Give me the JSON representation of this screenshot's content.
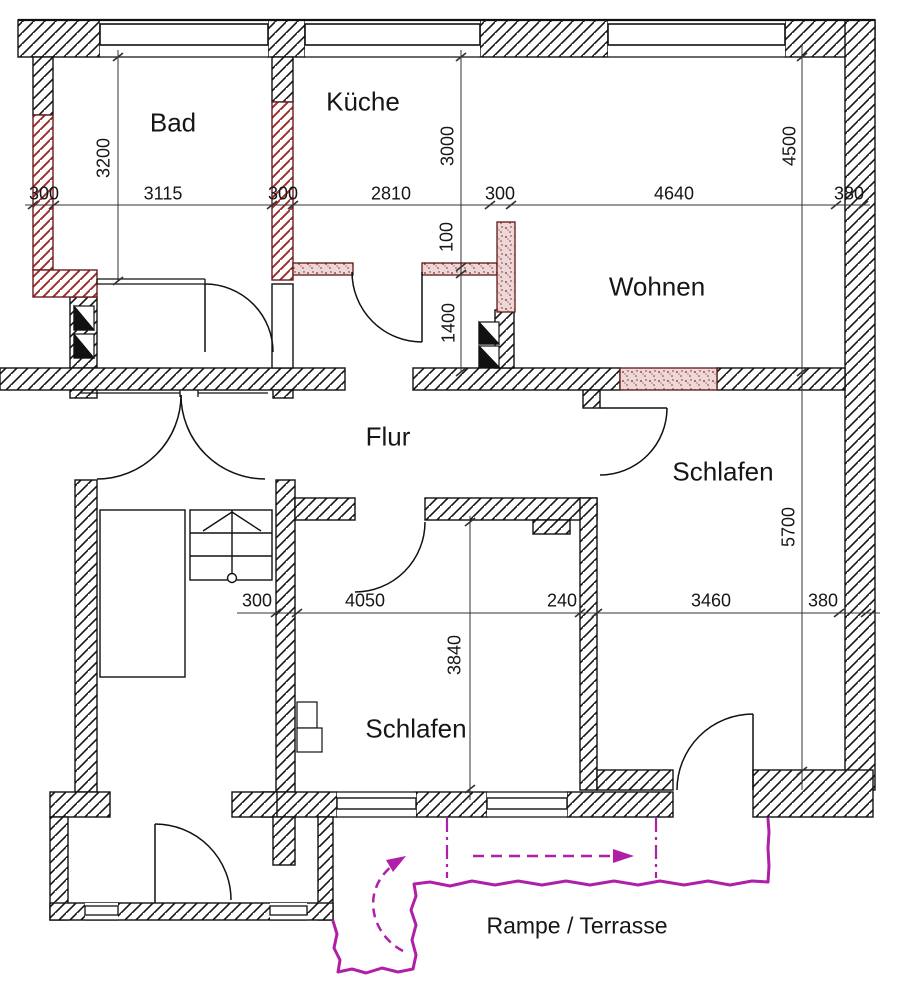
{
  "title": "Grundriss Wohnung (Umbauplan)",
  "rooms": {
    "bad": {
      "label": "Bad"
    },
    "kueche": {
      "label": "Küche"
    },
    "wohnen": {
      "label": "Wohnen"
    },
    "flur": {
      "label": "Flur"
    },
    "schlafen_right": {
      "label": "Schlafen"
    },
    "schlafen_bottom": {
      "label": "Schlafen"
    },
    "rampe": {
      "label": "Rampe / Terrasse"
    }
  },
  "dims": {
    "top": [
      "300",
      "3115",
      "300",
      "2810",
      "300",
      "4640",
      "380"
    ],
    "bottom": [
      "300",
      "4050",
      "240",
      "3460",
      "380"
    ],
    "bad_width": "3200",
    "kueche_depth": "3000",
    "new_wall": "100",
    "flur_zone": "1400",
    "wohnen_depth": "4500",
    "schlafen_depth": "5700",
    "schlafen_bottom_depth": "3840"
  },
  "colors": {
    "wall_line": "#111111",
    "demolition_red": "#9e2f2f",
    "new_wall_border": "#5f1818",
    "new_wall_fill": "#eed7d7",
    "ramp_magenta": "#b01fa8",
    "dim_line": "#333333"
  },
  "legend_semantics": {
    "black_hatch": "Bestand (existing wall)",
    "red_hatch": "Abbruch (red hatched wall)",
    "red_stipple": "Neubau (new wall)",
    "magenta_path": "Rampe / Terrasse outline"
  }
}
